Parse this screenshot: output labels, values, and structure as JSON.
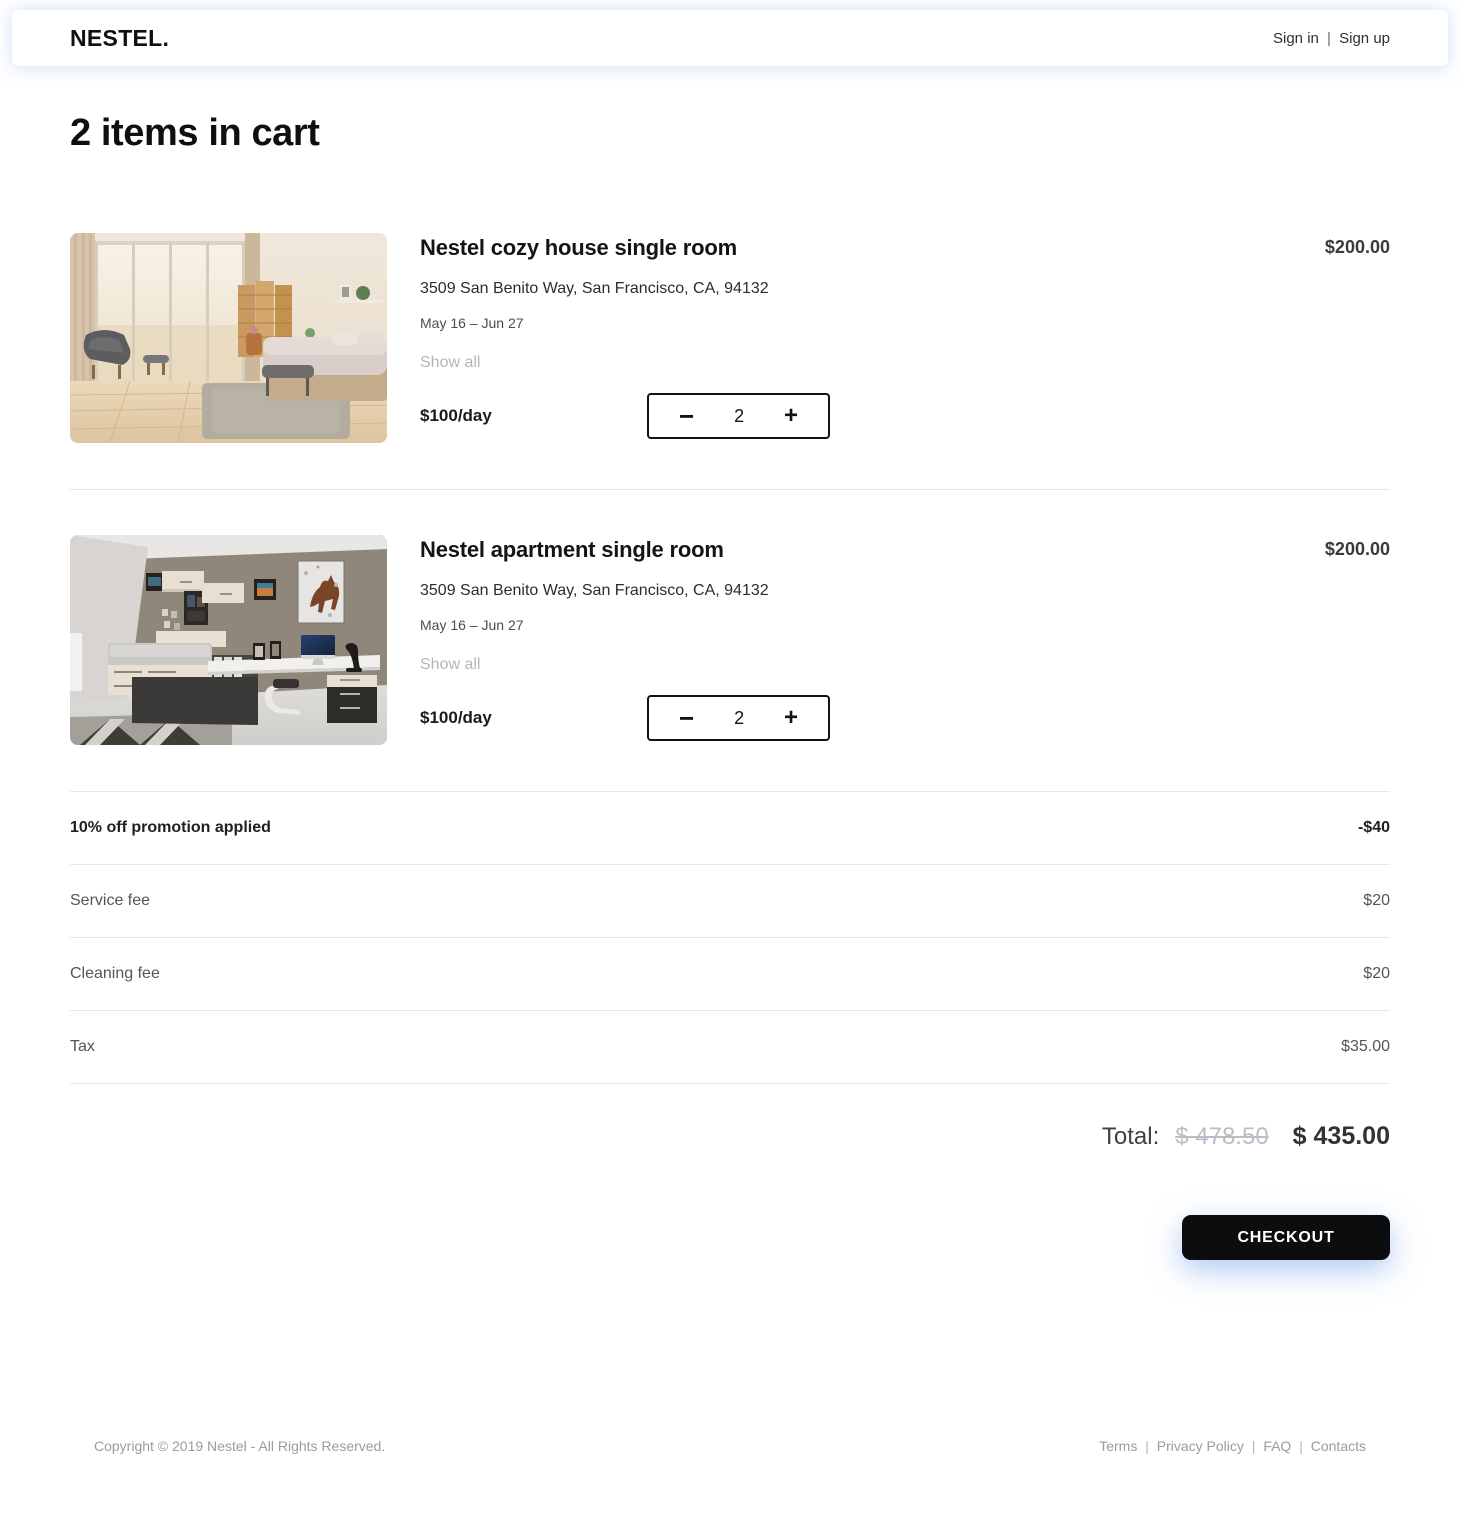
{
  "header": {
    "logo": "NESTEL.",
    "sign_in": "Sign in",
    "sign_up": "Sign up",
    "separator": "|"
  },
  "page": {
    "title": "2 items in cart"
  },
  "cart": {
    "items": [
      {
        "title": "Nestel cozy house single room",
        "address": "3509 San Benito Way, San Francisco, CA, 94132",
        "dates": "May 16 – Jun 27",
        "show_all": "Show all",
        "rate": "$100/day",
        "minus": "−",
        "quantity": "2",
        "plus": "+",
        "price": "$200.00"
      },
      {
        "title": "Nestel apartment single room",
        "address": "3509 San Benito Way, San Francisco, CA, 94132",
        "dates": "May 16 – Jun 27",
        "show_all": "Show all",
        "rate": "$100/day",
        "minus": "−",
        "quantity": "2",
        "plus": "+",
        "price": "$200.00"
      }
    ],
    "summary": [
      {
        "label": "10% off promotion applied",
        "value": "-$40"
      },
      {
        "label": "Service fee",
        "value": "$20"
      },
      {
        "label": "Cleaning fee",
        "value": "$20"
      },
      {
        "label": "Tax",
        "value": "$35.00"
      }
    ],
    "total": {
      "label": "Total:",
      "old_price": "$ 478.50",
      "new_price": "$ 435.00"
    },
    "checkout_label": "CHECKOUT"
  },
  "footer": {
    "copyright": "Copyright © 2019 Nestel - All Rights Reserved.",
    "separator": "|",
    "links": [
      "Terms",
      "Privacy Policy",
      "FAQ",
      "Contacts"
    ]
  },
  "colors": {
    "accent_glow": "#a5c3f0",
    "button_bg": "#0c0d0f",
    "divider": "#e7e7e9",
    "muted_text": "#b5b5b8"
  }
}
